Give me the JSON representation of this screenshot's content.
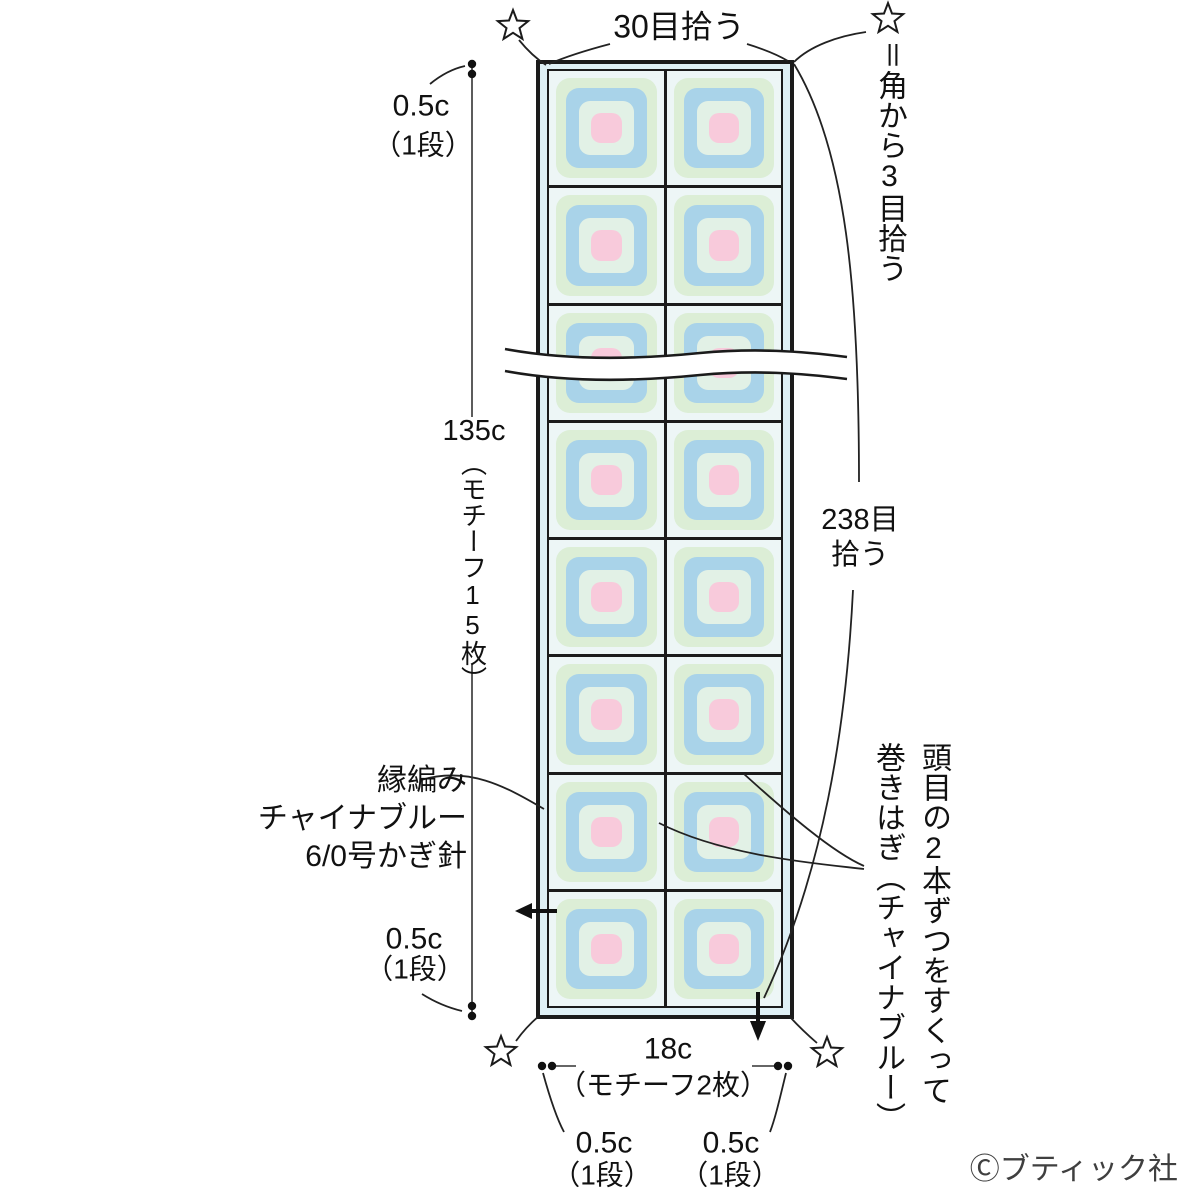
{
  "diagram": {
    "top_pickup_note": "30目拾う",
    "corner_note": {
      "star": "☆",
      "text": "＝角から3目拾う"
    },
    "left": {
      "top_measure": {
        "value": "0.5c",
        "rows": "（1段）"
      },
      "height_measure": {
        "value": "135c",
        "detail": "（モチーフ15枚）"
      },
      "bottom_measure": {
        "value": "0.5c",
        "rows": "（1段）"
      },
      "edging": {
        "line1": "縁編み",
        "line2": "チャイナブルー",
        "line3": "6/0号かぎ針"
      }
    },
    "right": {
      "pickup_measure": {
        "line1": "238目",
        "line2": "拾う"
      },
      "join_note": {
        "line1": "頭目の2本ずつをすくって",
        "line2": "巻きはぎ（チャイナブルー）"
      }
    },
    "bottom": {
      "width_measure": {
        "value": "18c",
        "detail": "（モチーフ2枚）"
      },
      "left_measure": {
        "value": "0.5c",
        "rows": "（1段）"
      },
      "right_measure": {
        "value": "0.5c",
        "rows": "（1段）"
      }
    },
    "copyright": "Ⓒブティック社",
    "grid": {
      "rows": 8,
      "cols": 2
    },
    "colors": {
      "outline": "#1b1b1b",
      "border_strip": "#dff0f5",
      "cell_bg": "#edf6f6",
      "motif_green": "#dceed6",
      "motif_blue": "#a9d3e9",
      "motif_mint": "#e2f1e6",
      "motif_pink": "#f8cadb"
    }
  }
}
